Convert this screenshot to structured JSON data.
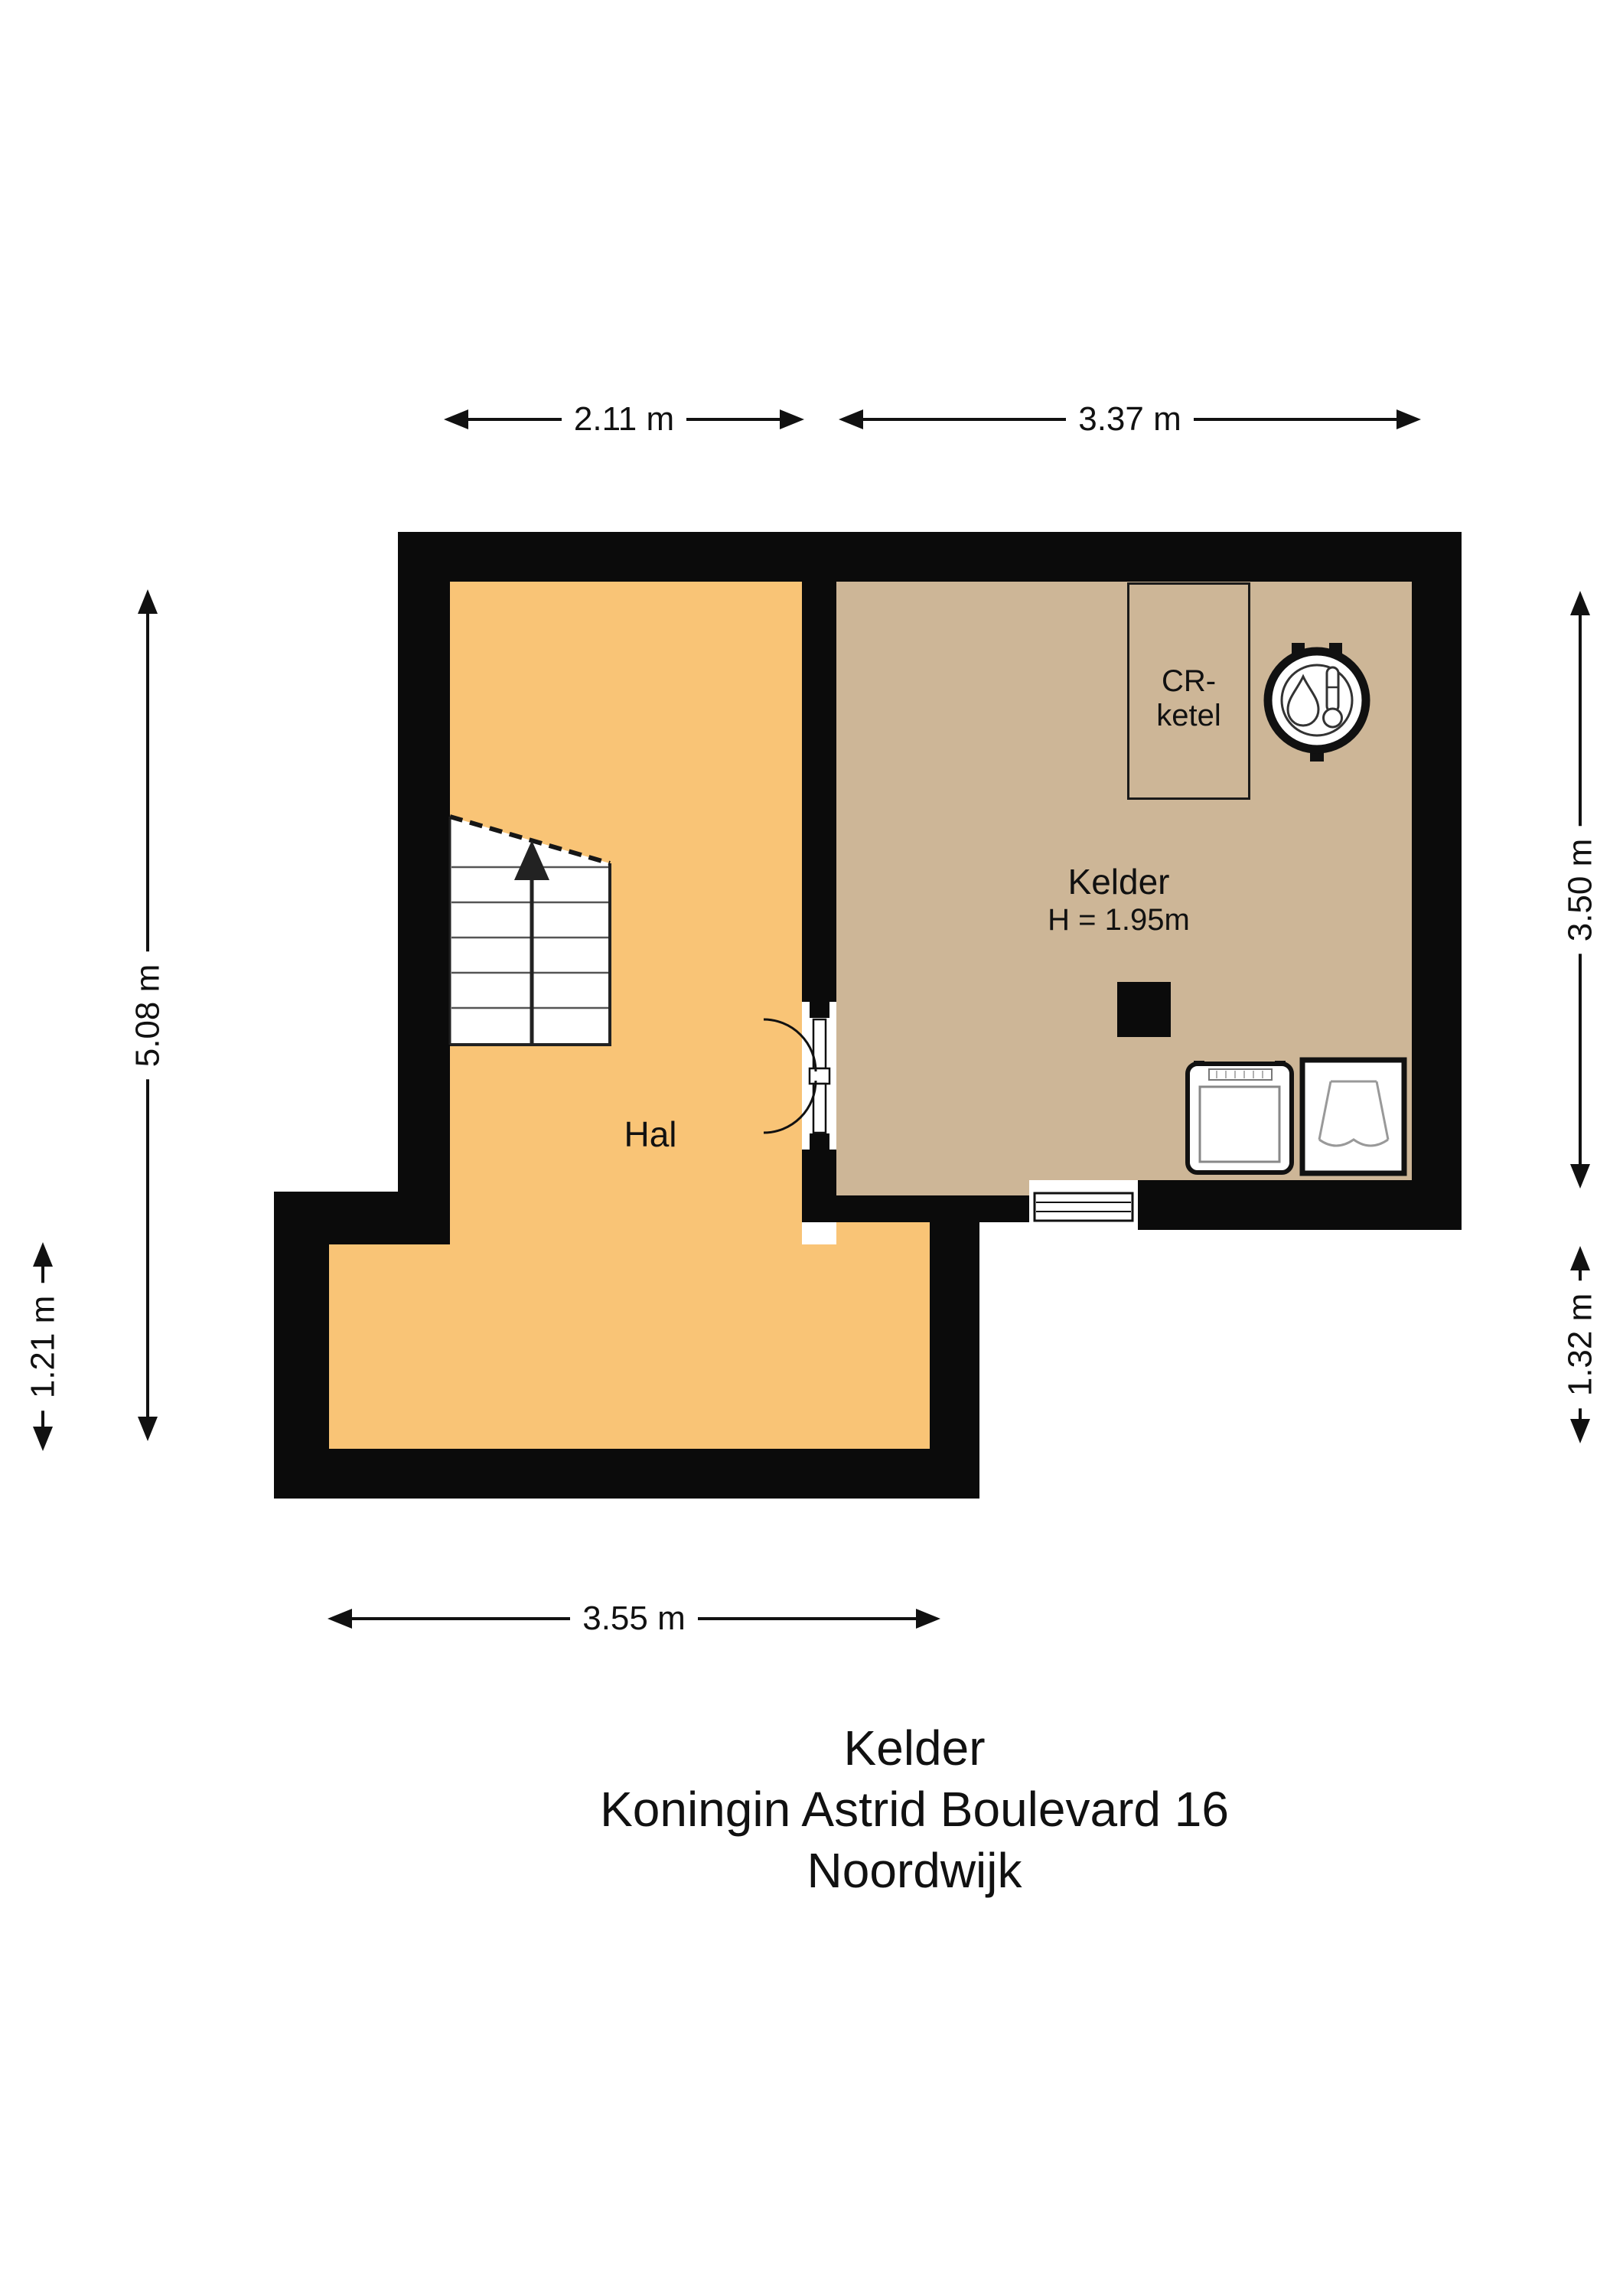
{
  "title": {
    "lines": [
      "Kelder",
      "Koningin Astrid Boulevard 16",
      "Noordwijk"
    ]
  },
  "rooms": {
    "hal": {
      "label": "Hal"
    },
    "kelder": {
      "label": "Kelder",
      "height_label": "H = 1.95m"
    },
    "cr_ketel": {
      "line1": "CR-",
      "line2": "ketel"
    }
  },
  "dimensions": {
    "top_left": "2.11 m",
    "top_right": "3.37 m",
    "left_inner": "5.08 m",
    "left_outer": "1.21 m",
    "right_upper": "3.50 m",
    "right_lower": "1.32 m",
    "bottom": "3.55 m"
  },
  "colors": {
    "wall": "#0b0b0b",
    "hal_floor": "#F9C476",
    "kelder_floor": "#CDB697",
    "background": "#FFFFFF"
  },
  "icons": [
    "boiler-icon",
    "washing-machine-icon",
    "sink-icon",
    "stairs-up-arrow-icon",
    "double-door-icon",
    "window-icon"
  ]
}
